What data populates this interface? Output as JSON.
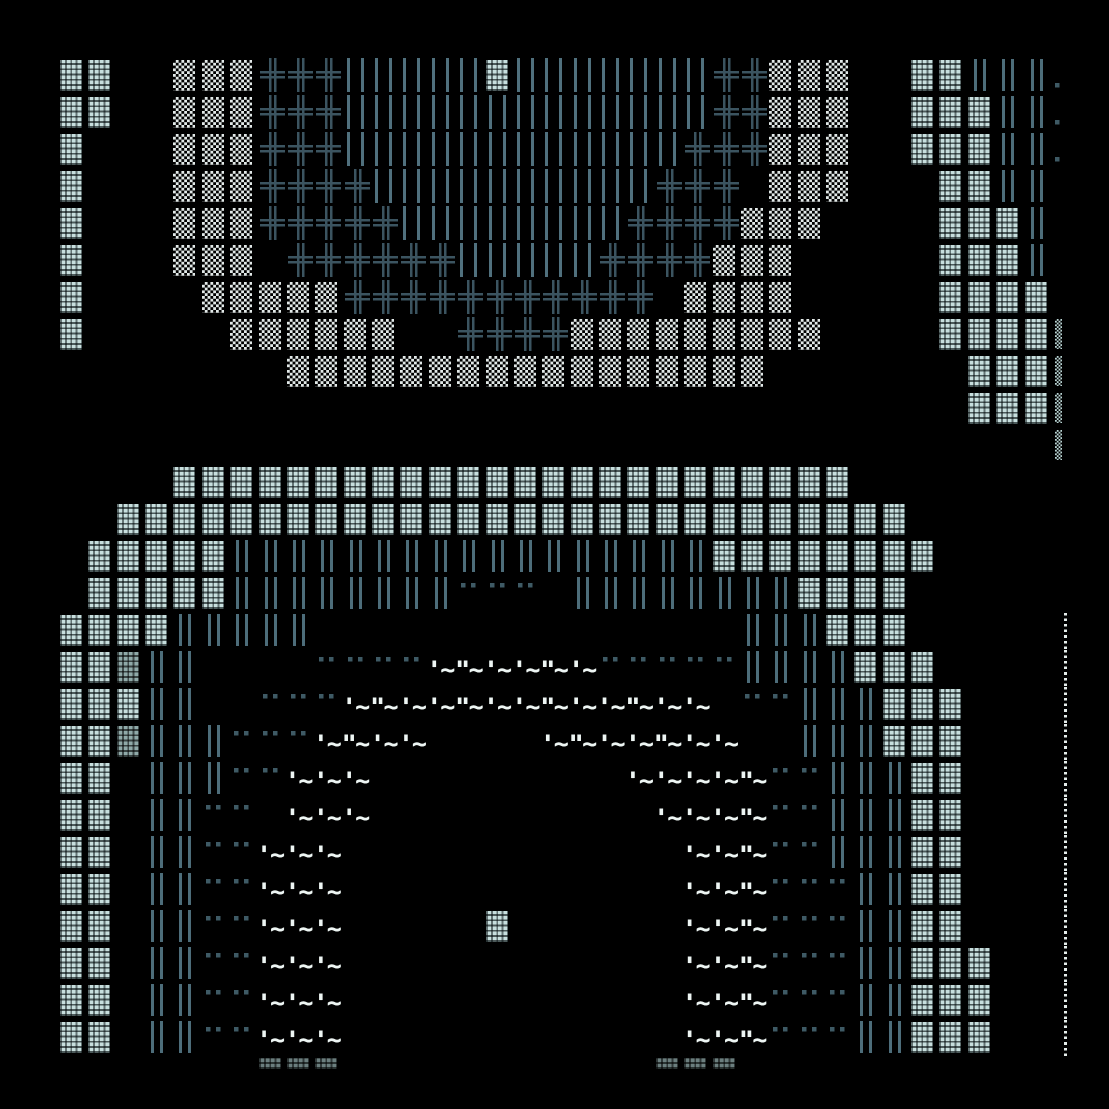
{
  "canvas": {
    "width": 1109,
    "height": 1109,
    "background": "#000000"
  },
  "grid": {
    "cols": 36,
    "rows": 28,
    "cell_w": 28.37,
    "cell_h": 37,
    "origin_x": 60,
    "origin_y": 57
  },
  "palette": {
    "bg": "#000000",
    "bright": "#c7dedd",
    "white": "#e2e9e8",
    "dim": "#8fa9a8",
    "bar": "#4d6d7a",
    "barN": "#50707d",
    "cross": "#3b5460",
    "dot": "#3e5a65",
    "wave": "#edf5f3",
    "squig": "#b9d4d3",
    "dline": "#e4ecea"
  },
  "legend": {
    ".": {
      "name": "empty"
    },
    "B": {
      "name": "block-bright-cell"
    },
    "W": {
      "name": "block-white-cell"
    },
    "D": {
      "name": "block-dim-cell"
    },
    "H": {
      "name": "block-fade-cell"
    },
    "I": {
      "name": "wall-double-bar-cell"
    },
    "N": {
      "name": "dense-bars-cell"
    },
    "P": {
      "name": "double-cross-cell"
    },
    "d": {
      "name": "dots-pair-cell"
    },
    "o": {
      "name": "dot-cell"
    },
    "q": {
      "name": "wave-cell",
      "text": "'~"
    },
    "Q": {
      "name": "wave-double-tick-cell",
      "text": "\"~"
    },
    "s": {
      "name": "zigzag-edge-cell"
    },
    "L": {
      "name": "dotted-line-cell"
    }
  },
  "rows": [
    "BB..WWWPPPNNNNNBNNNNNNNPPWWW..BBIIIo",
    "BB..WWWPPPNNNNNNNNNNNNNPPWWW..BBBIIo",
    "B...WWWPPPNNNNNNNNNNNNPPPWWW..BBBIIo",
    "B...WWWPPPPNNNNNNNNNNPPP.WWW...BBII.",
    "B...WWWPPPPPNNNNNNNNPPPPWWW....BBBI.",
    "B...WWW.PPPPPPNNNNNPPPPWWW.....BBBI.",
    "B....WWWWWPPPPPPPPPPP.WWWW.....BBBB.",
    "B.....WWWWWW..PPPPWWWWWWWWW....BBBBs",
    "........WWWWWWWWWWWWWWWWW.......BBBs",
    "................................BBBs",
    "...................................s",
    "....BBBBBBBBBBBBBBBBBBBBBBBB........",
    "..BBBBBBBBBBBBBBBBBBBBBBBBBBBB......",
    ".BBBBBIIIIIIIIIIIIIIIIIBBBBBBBB.....",
    ".BBBBBIIIIIIIIddd.IIIIIIIIBBBB......",
    "BBBBIIIII...............IIIBBB.....L",
    "BBDII....ddddqQqqQqdddddIIIIBBB....L",
    "BBBII..dddqQqqQqqQqqQqq.ddIIIBBB...L",
    "BBDIIIdddqQqq....qQqqQqq..IIIBBB...L",
    "BB.IIIddqqq.........qqqqQddIIIBB...L",
    "BB.IIdd.qqq..........qqqQddIIIBB...L",
    "BB.IIddqqq............qqQddIIIBB...L",
    "BB.IIddqqq............qqQdddIIBB...L",
    "BB.IIddqqq.....B......qqQdddIIBB...L",
    "BB.IIddqqq............qqQdddIIBBB..L",
    "BB.IIddqqq............qqQdddIIBBB..L",
    "BB.IIddqqq............qqQdddIIBBB..L",
    ".......HHH...........HHH............"
  ]
}
